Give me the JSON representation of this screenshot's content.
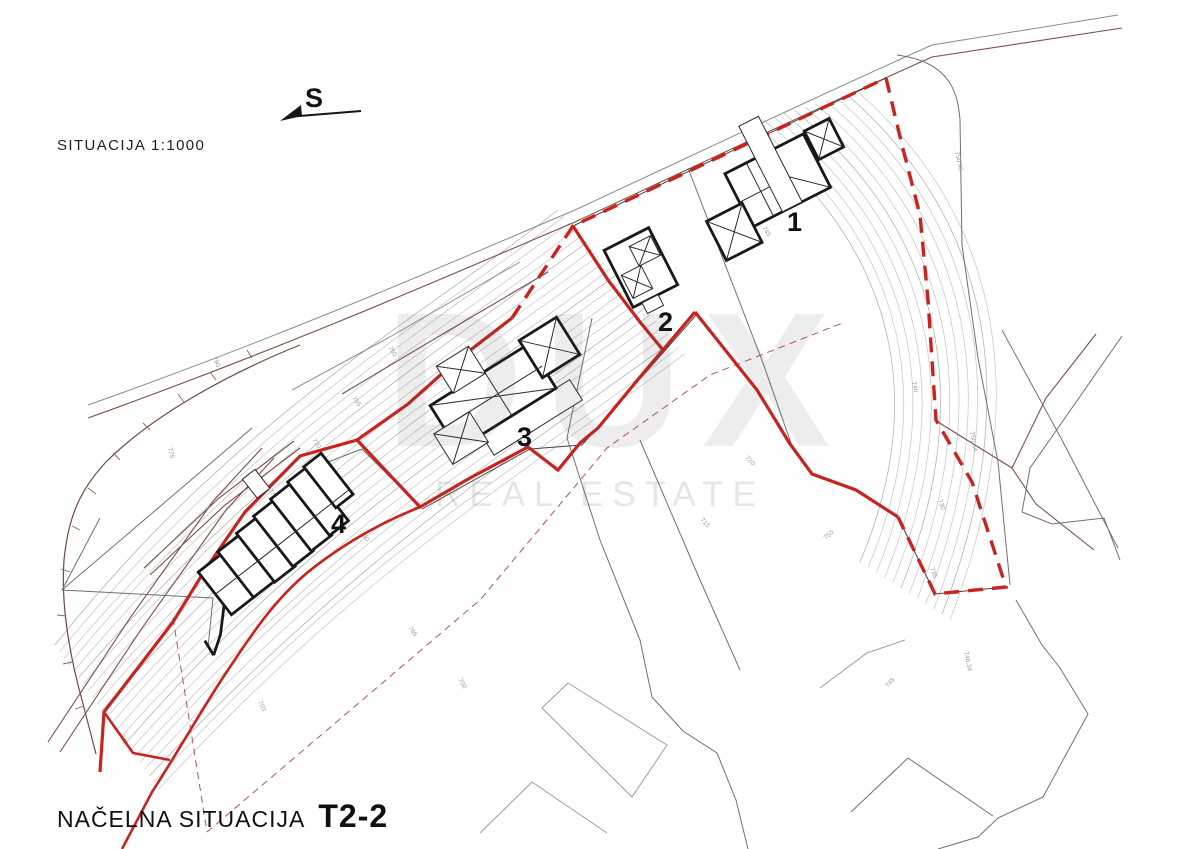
{
  "page": {
    "background": "#ffffff"
  },
  "header": {
    "scale_label": "SITUACIJA 1:1000",
    "north_symbol": "S"
  },
  "footer": {
    "title": "NAČELNA SITUACIJA",
    "plan_code": "T2-2"
  },
  "watermark": {
    "line1": "DUX",
    "line2": "REAL ESTATE"
  },
  "buildings": [
    {
      "label": "1"
    },
    {
      "label": "2"
    },
    {
      "label": "3"
    },
    {
      "label": "4"
    }
  ],
  "map": {
    "type": "site-plan",
    "scale": "1:1000",
    "colors": {
      "boundary_red": "#c8231c",
      "road_brown": "#7d4f46",
      "contour_gray": "#c7c7c7",
      "parcel_gray": "#707070",
      "building_black": "#181818"
    },
    "elevation_labels": [
      {
        "t": "750.45",
        "x": 955,
        "y": 152,
        "r": 78
      },
      {
        "t": "750.44",
        "x": 970,
        "y": 432,
        "r": 80
      },
      {
        "t": "746.34",
        "x": 964,
        "y": 652,
        "r": 78
      },
      {
        "t": "745",
        "x": 762,
        "y": 228,
        "r": 58
      },
      {
        "t": "750",
        "x": 826,
        "y": 540,
        "r": -42
      },
      {
        "t": "745",
        "x": 888,
        "y": 688,
        "r": -50
      },
      {
        "t": "735",
        "x": 930,
        "y": 568,
        "r": 72
      },
      {
        "t": "730",
        "x": 938,
        "y": 500,
        "r": 72
      },
      {
        "t": "740",
        "x": 912,
        "y": 382,
        "r": 78
      },
      {
        "t": "720",
        "x": 745,
        "y": 458,
        "r": 48
      },
      {
        "t": "715",
        "x": 700,
        "y": 520,
        "r": 48
      },
      {
        "t": "760",
        "x": 388,
        "y": 348,
        "r": 56
      },
      {
        "t": "765",
        "x": 352,
        "y": 398,
        "r": 56
      },
      {
        "t": "770",
        "x": 312,
        "y": 440,
        "r": 58
      },
      {
        "t": "775",
        "x": 268,
        "y": 490,
        "r": 60
      },
      {
        "t": "775",
        "x": 168,
        "y": 448,
        "r": 78
      },
      {
        "t": "780",
        "x": 212,
        "y": 358,
        "r": 62
      },
      {
        "t": "765",
        "x": 408,
        "y": 628,
        "r": 55
      },
      {
        "t": "700",
        "x": 458,
        "y": 680,
        "r": 58
      },
      {
        "t": "745",
        "x": 120,
        "y": 735,
        "r": 70
      },
      {
        "t": "703",
        "x": 258,
        "y": 702,
        "r": 64
      },
      {
        "t": "710",
        "x": 360,
        "y": 533,
        "r": 55
      }
    ]
  }
}
